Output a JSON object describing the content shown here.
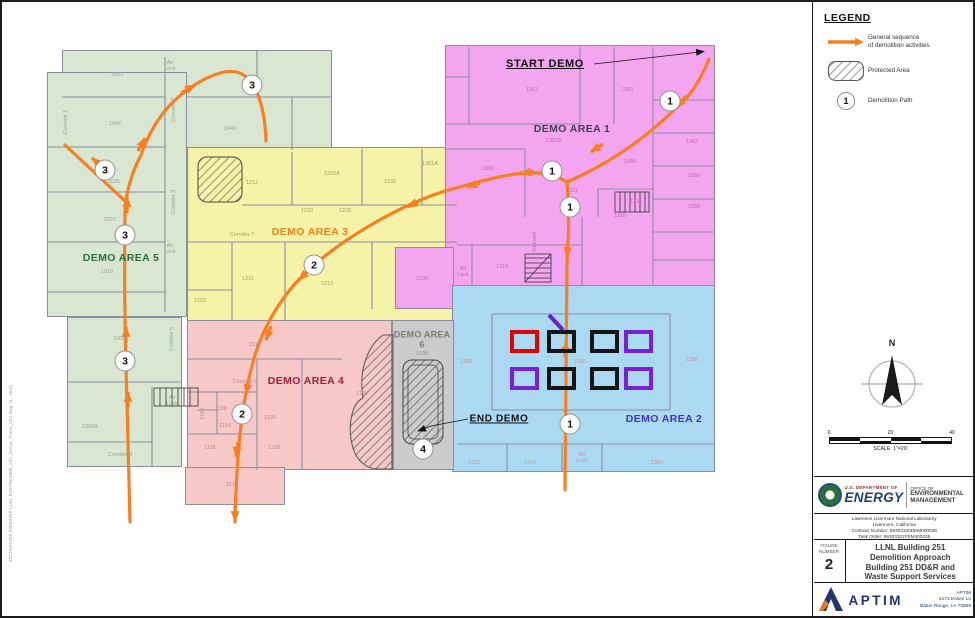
{
  "stamp": {
    "text": "2023\\501806.00003459   LLNL  B251\\501806_251_Demo_Plans_251.dwg      11, 2024"
  },
  "legend": {
    "title": "LEGEND",
    "items": [
      {
        "label": "General sequence\nof demolition activities"
      },
      {
        "label": "Protected Area"
      },
      {
        "label": "Demolition Path",
        "symbol": "1"
      }
    ]
  },
  "compass": {
    "n": "N"
  },
  "scalebar": {
    "ticks": [
      "0",
      "20",
      "40"
    ],
    "caption": "SCALE: 1\"=20'"
  },
  "title_block": {
    "doe": {
      "dept_small": "U.S. DEPARTMENT OF",
      "dept_big": "ENERGY",
      "office_small": "OFFICE OF",
      "office_line1": "ENVIRONMENTAL",
      "office_line2": "MANAGEMENT"
    },
    "lab_lines": [
      "Lawrence Livermore National Laboratory",
      "Livermore, California",
      "Contract Number: 89303320DEM000038",
      "Task Order: 89303321FEM400225"
    ],
    "figure_label_1": "FIGURE",
    "figure_label_2": "NUMBER",
    "figure_number": "2",
    "title_lines": [
      "LLNL Building 251",
      "Demolition Approach",
      "Building 251 DD&R and",
      "Waste Support Services"
    ],
    "aptim": {
      "name": "APTIM",
      "address_lines": [
        "APTIM",
        "4171 Essen Ln",
        "Baton Rouge, LA 70809"
      ]
    }
  },
  "plan": {
    "annotations": {
      "start_label": "START DEMO",
      "end_label": "END DEMO"
    },
    "areas": [
      {
        "id": "demo-area-1",
        "label": "DEMO AREA 1",
        "color": "#f4a5ef",
        "label_color": "#3f3f55"
      },
      {
        "id": "demo-area-2",
        "label": "DEMO AREA 2",
        "color": "#abd9f2",
        "label_color": "#3b34c4"
      },
      {
        "id": "demo-area-3",
        "label": "DEMO AREA 3",
        "color": "#f6f2a8",
        "label_color": "#e8821e"
      },
      {
        "id": "demo-area-4",
        "label": "DEMO AREA 4",
        "color": "#f6c8c8",
        "label_color": "#9c1f3d"
      },
      {
        "id": "demo-area-5",
        "label": "DEMO AREA 5",
        "color": "#d9e7d2",
        "label_color": "#27713b"
      },
      {
        "id": "demo-area-6",
        "label": "DEMO AREA 6",
        "color": "#cbcbcb",
        "label_color": "#7a7a7a"
      }
    ],
    "colors": {
      "sequence_arrow": "#f57f21",
      "equipment_red": "#e00000",
      "equipment_black": "#151515",
      "equipment_purple": "#7a1fd6",
      "walls": "#8a8da0"
    },
    "markers": [
      {
        "n": "1",
        "x": 668,
        "y": 99
      },
      {
        "n": "1",
        "x": 550,
        "y": 169
      },
      {
        "n": "1",
        "x": 568,
        "y": 205
      },
      {
        "n": "1",
        "x": 568,
        "y": 422
      },
      {
        "n": "2",
        "x": 312,
        "y": 263
      },
      {
        "n": "2",
        "x": 240,
        "y": 412
      },
      {
        "n": "3",
        "x": 250,
        "y": 83
      },
      {
        "n": "3",
        "x": 103,
        "y": 168
      },
      {
        "n": "3",
        "x": 123,
        "y": 233
      },
      {
        "n": "3",
        "x": 123,
        "y": 359
      },
      {
        "n": "4",
        "x": 421,
        "y": 447
      }
    ],
    "rooms": [
      {
        "t": "1053",
        "x": 115,
        "y": 73,
        "c": "g"
      },
      {
        "t": "1047",
        "x": 113,
        "y": 122,
        "c": "g"
      },
      {
        "t": "1049",
        "x": 228,
        "y": 127,
        "c": "g"
      },
      {
        "t": "1035",
        "x": 112,
        "y": 180,
        "c": "g"
      },
      {
        "t": "1027",
        "x": 108,
        "y": 218,
        "c": "g"
      },
      {
        "t": "1019",
        "x": 105,
        "y": 270,
        "c": "g"
      },
      {
        "t": "1005",
        "x": 117,
        "y": 337,
        "c": "g"
      },
      {
        "t": "1001A",
        "x": 88,
        "y": 425,
        "c": "g"
      },
      {
        "t": "Corridor 1",
        "x": 64,
        "y": 120,
        "c": "g",
        "v": 1
      },
      {
        "t": "Corridor 2",
        "x": 172,
        "y": 108,
        "c": "g",
        "v": 1
      },
      {
        "t": "Corridor 3",
        "x": 172,
        "y": 200,
        "c": "g",
        "v": 1
      },
      {
        "t": "Corridor 5",
        "x": 170,
        "y": 337,
        "c": "g",
        "v": 1
      },
      {
        "t": "Corridor 4",
        "x": 118,
        "y": 453,
        "c": "g"
      },
      {
        "t": "Air Lock",
        "x": 168,
        "y": 64,
        "c": "g",
        "w": 14
      },
      {
        "t": "Air Lock",
        "x": 168,
        "y": 247,
        "c": "g",
        "w": 14
      },
      {
        "t": "Air Lock",
        "x": 170,
        "y": 399,
        "c": "g",
        "w": 14
      },
      {
        "t": "1212",
        "x": 250,
        "y": 181,
        "c": "y"
      },
      {
        "t": "1226A",
        "x": 330,
        "y": 172,
        "c": "y"
      },
      {
        "t": "1232",
        "x": 388,
        "y": 180,
        "c": "y"
      },
      {
        "t": "1301A",
        "x": 428,
        "y": 162,
        "c": "y"
      },
      {
        "t": "1220",
        "x": 305,
        "y": 209,
        "c": "y"
      },
      {
        "t": "1228",
        "x": 343,
        "y": 209,
        "c": "y"
      },
      {
        "t": "Corridor 7",
        "x": 240,
        "y": 233,
        "c": "y"
      },
      {
        "t": "1211",
        "x": 246,
        "y": 277,
        "c": "y"
      },
      {
        "t": "1219",
        "x": 325,
        "y": 282,
        "c": "y"
      },
      {
        "t": "1203",
        "x": 198,
        "y": 299,
        "c": "y"
      },
      {
        "t": "1235",
        "x": 420,
        "y": 277,
        "c": "m"
      },
      {
        "t": "1313",
        "x": 530,
        "y": 88,
        "c": "m"
      },
      {
        "t": "1363",
        "x": 625,
        "y": 88,
        "c": "m"
      },
      {
        "t": "1301B",
        "x": 552,
        "y": 139,
        "c": "m"
      },
      {
        "t": "1301",
        "x": 486,
        "y": 167,
        "c": "m"
      },
      {
        "t": "1362",
        "x": 690,
        "y": 140,
        "c": "m"
      },
      {
        "t": "1359",
        "x": 628,
        "y": 160,
        "c": "m"
      },
      {
        "t": "1360",
        "x": 692,
        "y": 174,
        "c": "m"
      },
      {
        "t": "1321",
        "x": 570,
        "y": 189,
        "c": "m"
      },
      {
        "t": "1331",
        "x": 634,
        "y": 200,
        "c": "m"
      },
      {
        "t": "1318",
        "x": 618,
        "y": 214,
        "c": "m"
      },
      {
        "t": "1358",
        "x": 692,
        "y": 205,
        "c": "m"
      },
      {
        "t": "1310",
        "x": 500,
        "y": 265,
        "c": "m"
      },
      {
        "t": "Stairwell",
        "x": 533,
        "y": 240,
        "c": "m",
        "v": 1
      },
      {
        "t": "Air Lock",
        "x": 461,
        "y": 270,
        "c": "m",
        "w": 14
      },
      {
        "t": "1302",
        "x": 464,
        "y": 360,
        "c": "b"
      },
      {
        "t": "1320",
        "x": 578,
        "y": 360,
        "c": "b"
      },
      {
        "t": "1356",
        "x": 690,
        "y": 358,
        "c": "b"
      },
      {
        "t": "1312",
        "x": 472,
        "y": 461,
        "c": "b"
      },
      {
        "t": "1314",
        "x": 528,
        "y": 461,
        "c": "b"
      },
      {
        "t": "1354",
        "x": 655,
        "y": 461,
        "c": "b"
      },
      {
        "t": "Air Lock",
        "x": 580,
        "y": 456,
        "c": "b",
        "w": 14
      },
      {
        "t": "1117",
        "x": 253,
        "y": 343,
        "c": "p"
      },
      {
        "t": "1150",
        "x": 360,
        "y": 392,
        "c": "p"
      },
      {
        "t": "Corridor 6",
        "x": 243,
        "y": 380,
        "c": "p"
      },
      {
        "t": "1108",
        "x": 219,
        "y": 407,
        "c": "p"
      },
      {
        "t": "1102",
        "x": 201,
        "y": 412,
        "c": "p",
        "v": 1
      },
      {
        "t": "1114",
        "x": 223,
        "y": 424,
        "c": "p"
      },
      {
        "t": "1130",
        "x": 268,
        "y": 416,
        "c": "p"
      },
      {
        "t": "1116",
        "x": 208,
        "y": 446,
        "c": "p"
      },
      {
        "t": "1128",
        "x": 272,
        "y": 446,
        "c": "p"
      },
      {
        "t": "1118",
        "x": 230,
        "y": 483,
        "c": "p"
      },
      {
        "t": "1105",
        "x": 420,
        "y": 352,
        "c": "gr"
      }
    ]
  }
}
